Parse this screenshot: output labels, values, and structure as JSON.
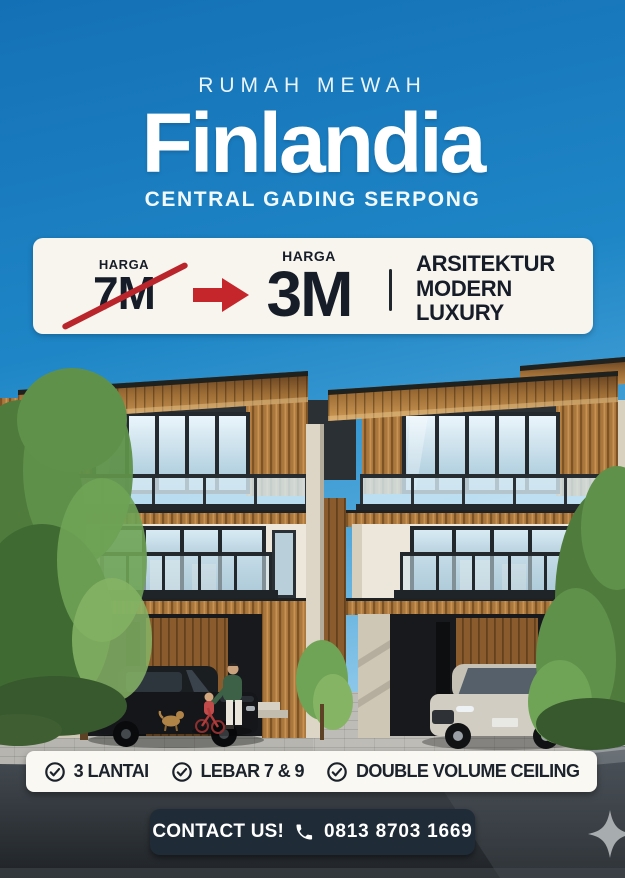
{
  "poster": {
    "kicker": "RUMAH MEWAH",
    "title": "Finlandia",
    "location": "CENTRAL GADING SERPONG"
  },
  "price_card": {
    "old_price": {
      "label": "HARGA",
      "value": "7M",
      "strikethrough": true
    },
    "arrow_icon": "red-arrow-right",
    "new_price": {
      "label": "HARGA",
      "value": "3M"
    },
    "tagline": [
      "ARSITEKTUR",
      "MODERN",
      "LUXURY"
    ]
  },
  "features": [
    {
      "icon": "check-circle-icon",
      "label": "3 LANTAI"
    },
    {
      "icon": "check-circle-icon",
      "label": "LEBAR 7 & 9"
    },
    {
      "icon": "check-circle-icon",
      "label": "DOUBLE VOLUME CEILING"
    }
  ],
  "contact": {
    "cta": "CONTACT US!",
    "icon": "phone-icon",
    "phone": "0813 8703 1669"
  },
  "watermark_icon": "sparkle-icon",
  "colors": {
    "sky_top": "#1470b5",
    "sky_bottom": "#bfe0f2",
    "card_bg": "#f8f5ee",
    "accent_red": "#b9252b",
    "text_dark": "#161d29",
    "features_bg": "#faf8f2",
    "contact_bg": "#1f2b37",
    "white": "#ffffff"
  }
}
